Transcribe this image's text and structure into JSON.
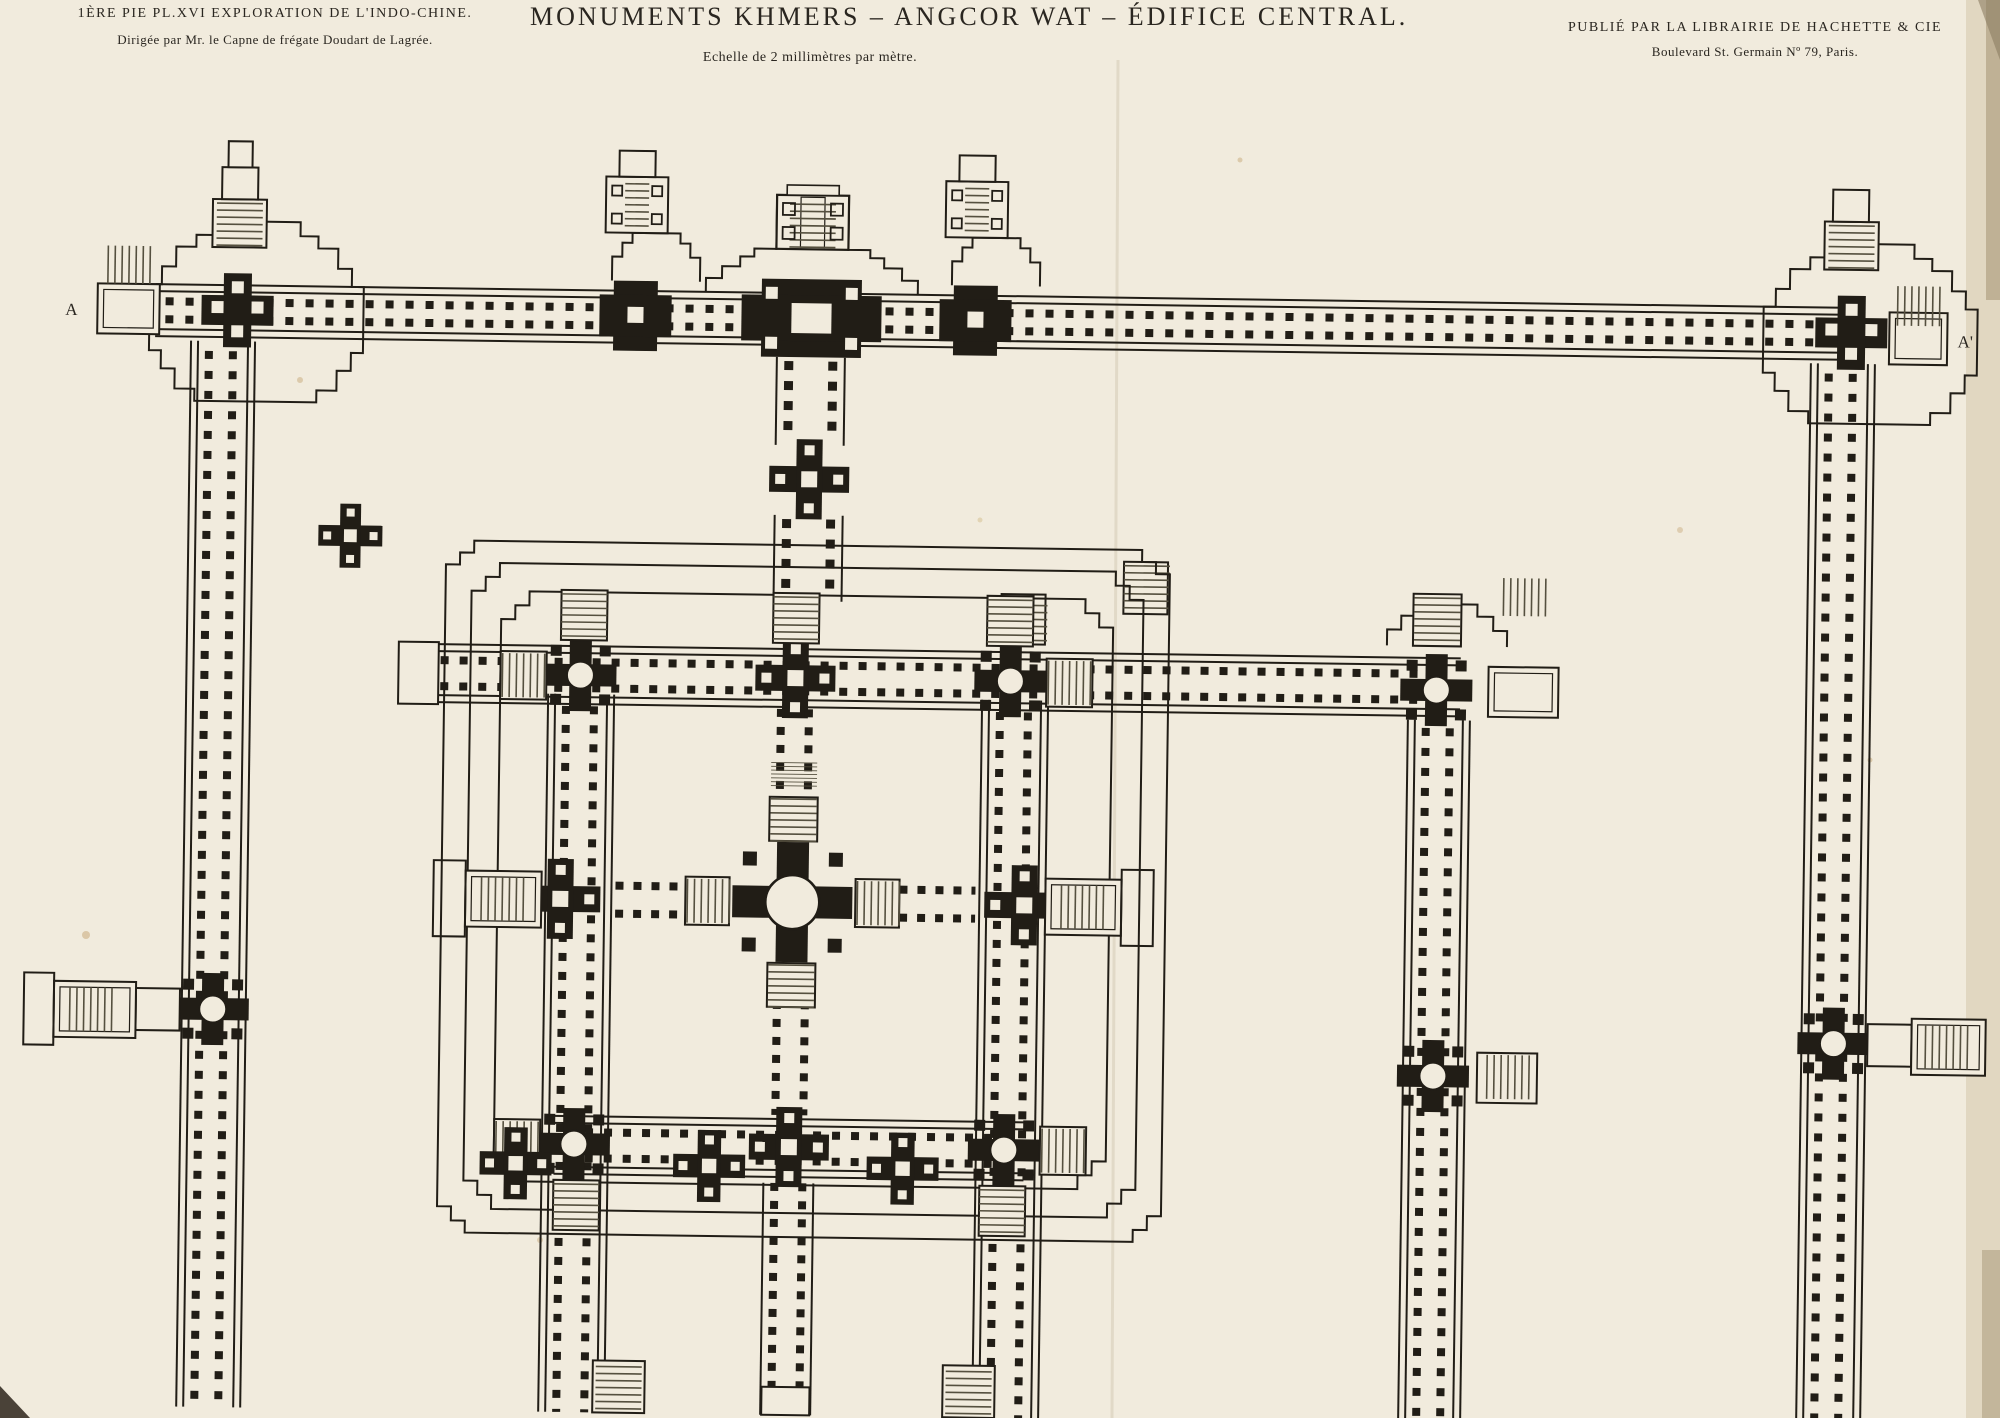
{
  "plate": {
    "series_line": "1ÈRE PIE PL.XVI EXPLORATION DE L'INDO-CHINE.",
    "direction_line": "Dirigée par Mr. le Capne de frégate Doudart de Lagrée.",
    "title": "MONUMENTS KHMERS – ANGCOR WAT – ÉDIFICE CENTRAL.",
    "scale_note": "Echelle de 2 millimètres par mètre.",
    "publisher_line": "PUBLIÉ PAR LA LIBRAIRIE DE HACHETTE & CIE",
    "publisher_address": "Boulevard St. Germain Nº 79, Paris.",
    "section_marker_left": "A",
    "section_marker_right": "A'"
  },
  "colors": {
    "paper": "#f1ebdd",
    "ink": "#211d16",
    "hatch": "#55503f",
    "paper_edge": "#c9b998",
    "foxing": "#c8a97a"
  },
  "plan": {
    "subject": "floor plan of the central temple of Angkor Wat",
    "outer_gallery": "colonnaded enclosure gallery with corner pavilions and section line A–A'",
    "west_gopura": "grand axial gate with staircase tower",
    "second_gallery": "middle enclosure gallery with circular corner towers",
    "bakan": "central quincunx sanctuary with circular central tower and axial stairways"
  }
}
